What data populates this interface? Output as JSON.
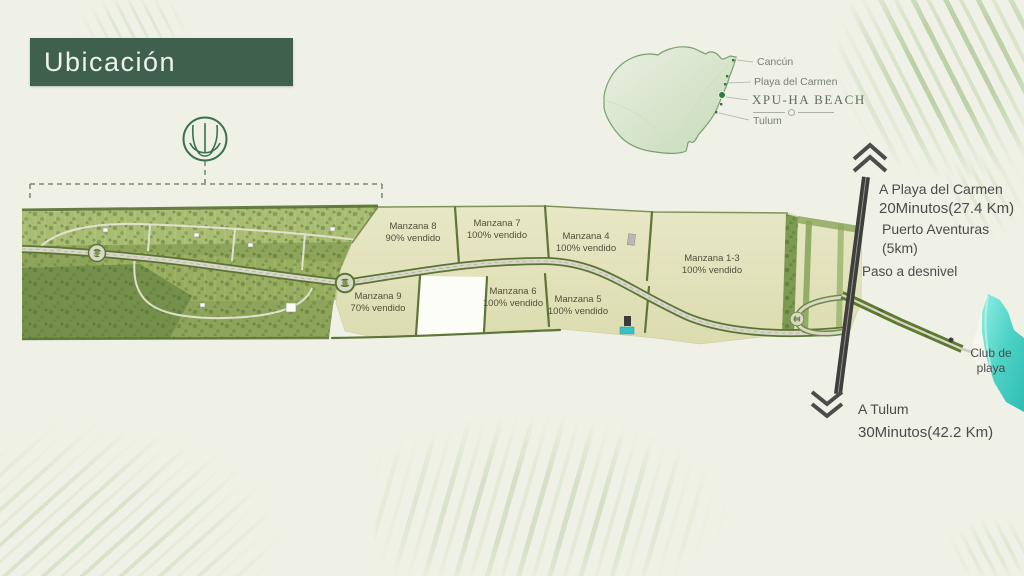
{
  "title": "Ubicación",
  "minimap": {
    "places": {
      "cancun": "Cancún",
      "playa_del_carmen": "Playa del Carmen",
      "xpuha": "XPU-HA BEACH",
      "tulum": "Tulum"
    }
  },
  "site": {
    "manzanas": [
      {
        "name": "Manzana 8",
        "status": "90% vendido"
      },
      {
        "name": "Manzana 7",
        "status": "100% vendido"
      },
      {
        "name": "Manzana 4",
        "status": "100% vendido"
      },
      {
        "name": "Manzana 1-3",
        "status": "100% vendido"
      },
      {
        "name": "Manzana 9",
        "status": "70% vendido"
      },
      {
        "name": "Manzana 6",
        "status": "100% vendido"
      },
      {
        "name": "Manzana 5",
        "status": "100% vendido"
      }
    ]
  },
  "directions": {
    "north_line1": "A Playa del Carmen",
    "north_line2": "20Minutos(27.4 Km)",
    "puerto_aventuras": "Puerto Aventuras (5km)",
    "paso_desnivel": "Paso a desnivel",
    "club_line1": "Club de",
    "club_line2": "playa",
    "south_line1": "A Tulum",
    "south_line2": "30Minutos(42.2 Km)"
  },
  "colors": {
    "accent_green": "#40604e",
    "emblem_green": "#3c7150",
    "map_beige": "#e3e3bd",
    "hedge_green": "#5d7637",
    "water_turquoise": "#4ed2c6",
    "brush_green": "#94b575",
    "label_gray": "#4b4b4b"
  }
}
